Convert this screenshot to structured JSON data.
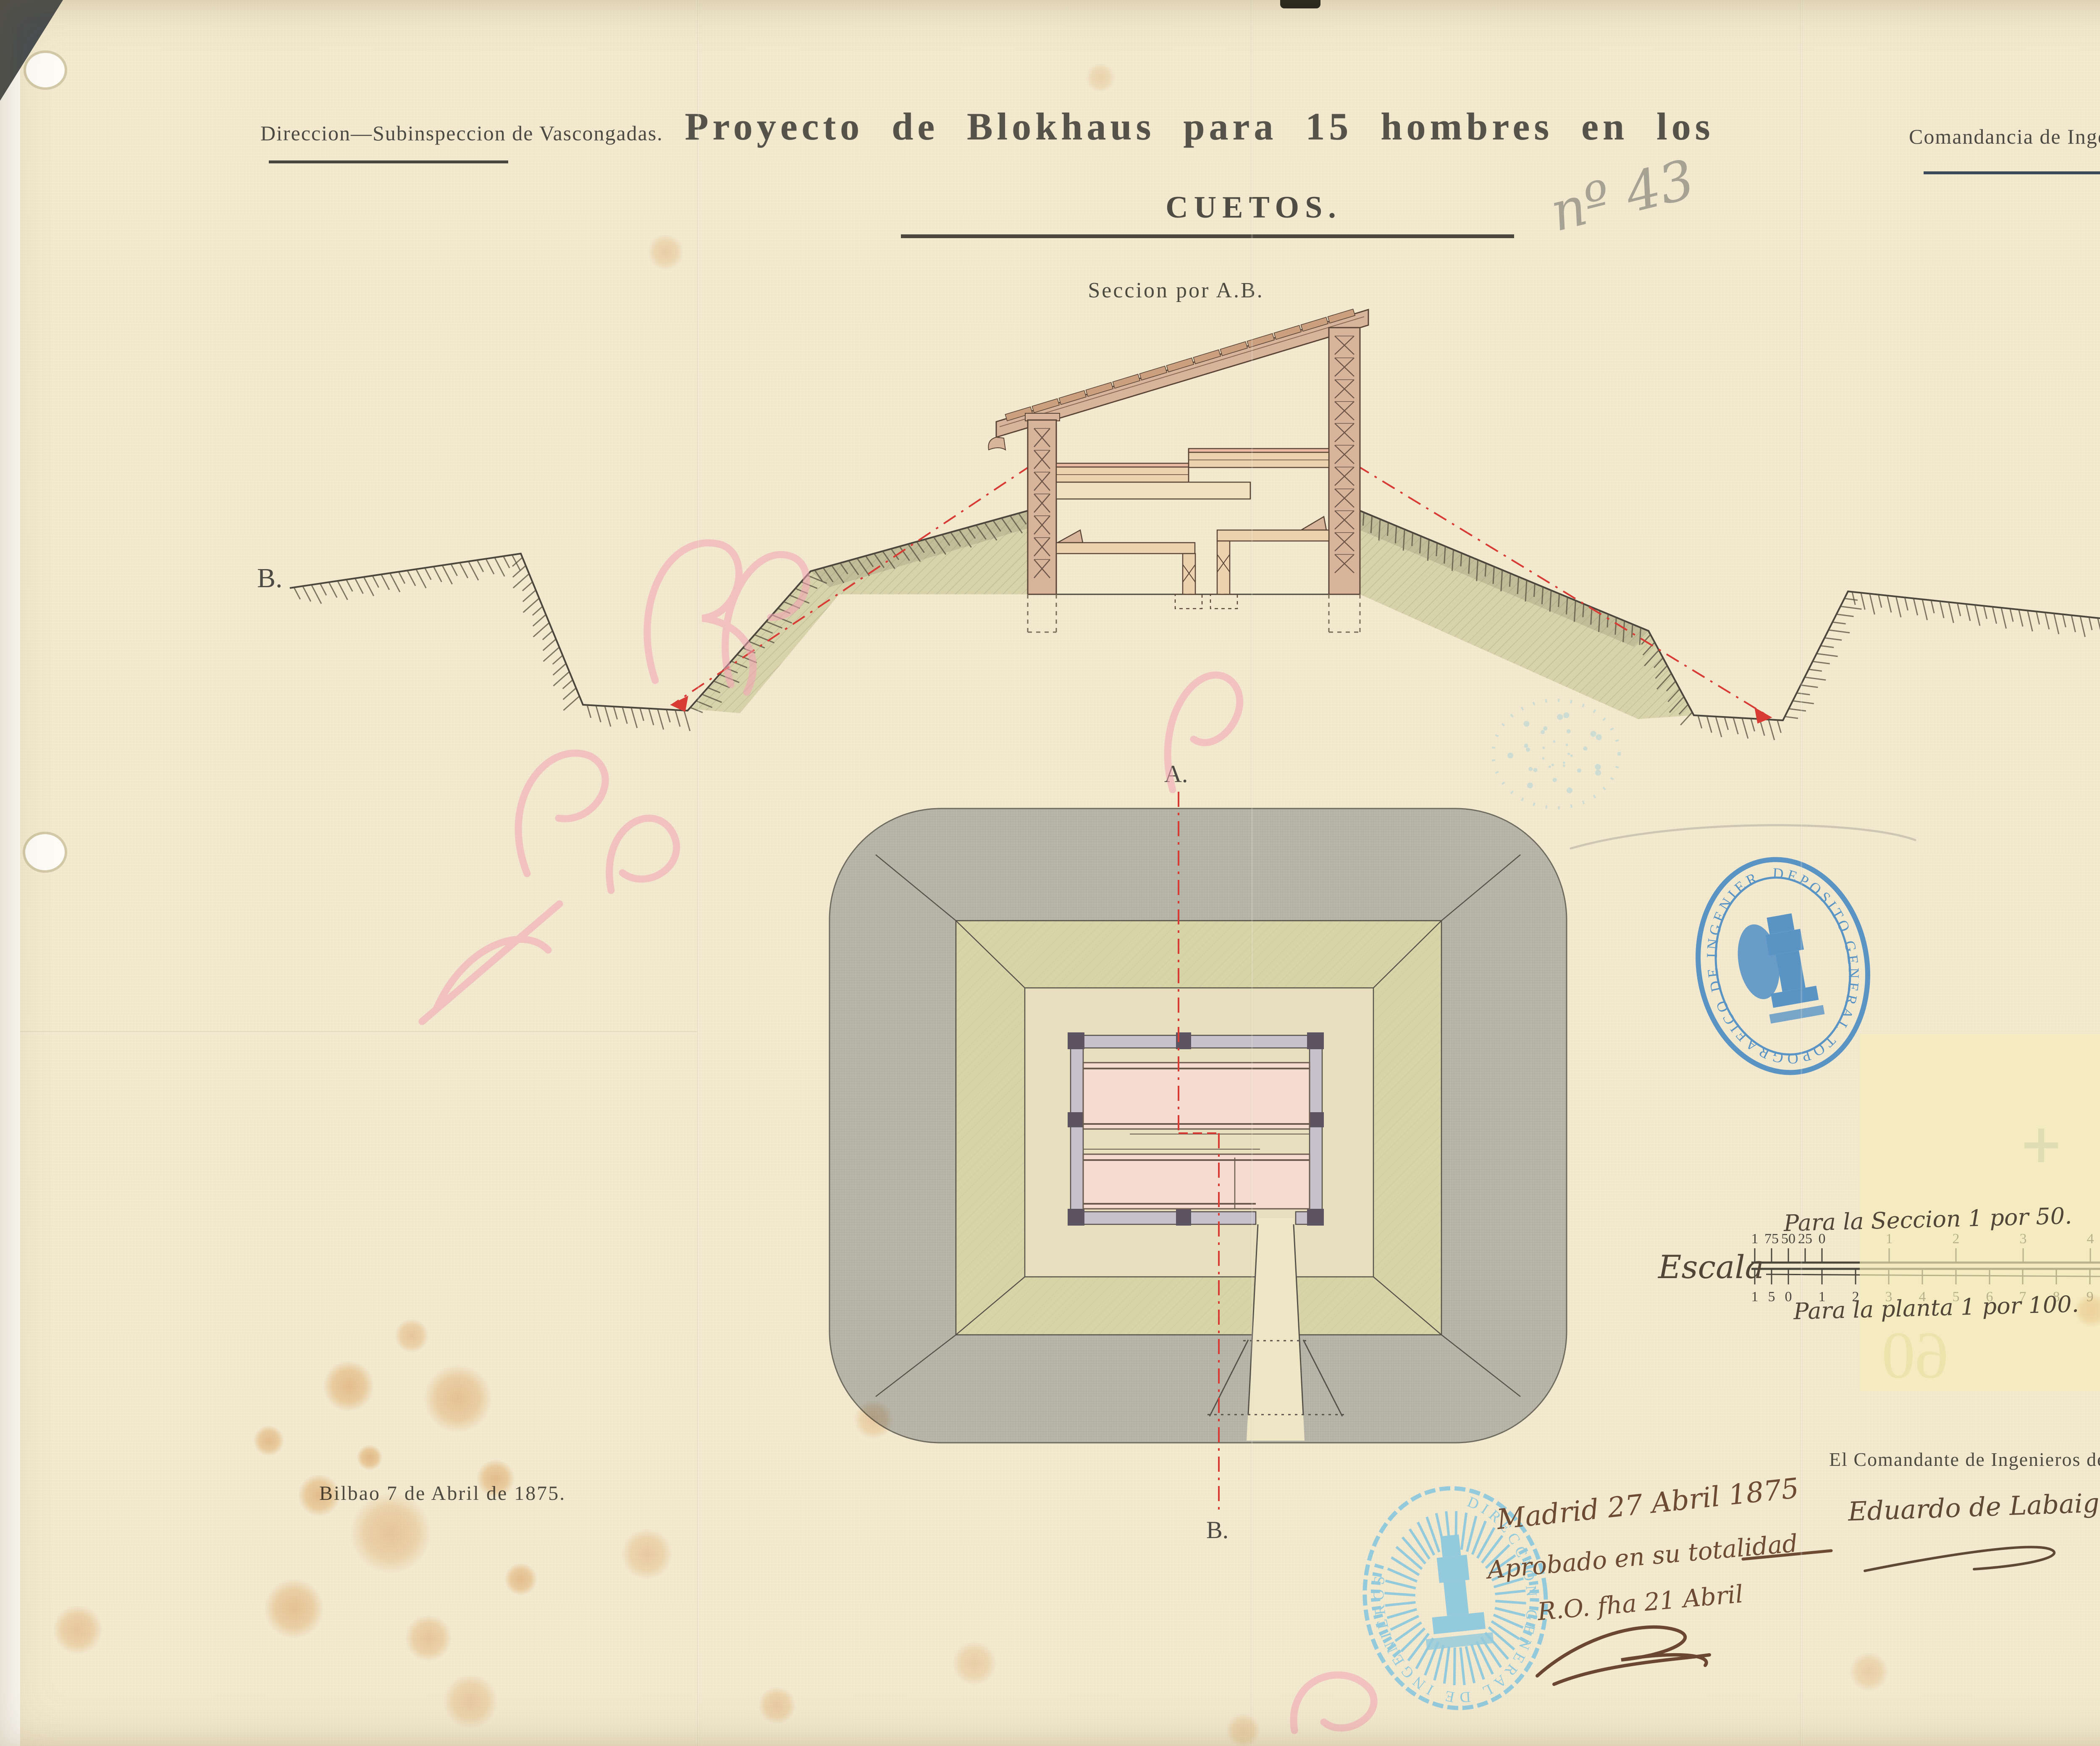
{
  "document": {
    "header_left": "Direccion—Subinspeccion de Vascongadas.",
    "header_right": "Comandancia de Ingenieros de Bilbao.",
    "title_line1": "Proyecto de Blokhaus para 15 hombres en los",
    "title_line2": "CUETOS.",
    "pencil_number": "nº 43",
    "section_caption": "Seccion por A.B.",
    "section_label_left": "B.",
    "section_label_right": "A.",
    "plan_label_top": "A.",
    "plan_label_bottom": "B.",
    "date_place": "Bilbao 7 de Abril de 1875.",
    "approval_line1": "Madrid 27 Abril 1875",
    "approval_line2": "Aprobado en su totalidad",
    "approval_line3": "R.O. fha 21 Abril",
    "signature_title": "El Comandante de Ingenieros de la plaza.",
    "signature_name": "Eduardo de Labaig"
  },
  "scale_bar": {
    "label": "Escala",
    "caption_top": "Para la Seccion 1 por 50.",
    "caption_bottom": "Para la planta 1 por 100.",
    "unit": "metros.",
    "top_ticks": [
      "1",
      "75",
      "50",
      "25",
      "0",
      "1",
      "2",
      "3",
      "4",
      "5"
    ],
    "bottom_ticks": [
      "1",
      "5",
      "0",
      "1",
      "2",
      "3",
      "4",
      "5",
      "6",
      "7",
      "8",
      "9",
      "10",
      "11"
    ]
  },
  "stamps": {
    "middle_oval_text": "DEPOSITO GENERAL TOPOGRAFICO DE INGENIEROS",
    "bottom_oval_text": "DIRECCION GENERAL DE INGENIEROS"
  },
  "show_through": {
    "verso_card_fields": [
      "Número",
      "Signatura",
      "N.º de hojas",
      "Hoja n.º"
    ],
    "ghost_number": "60"
  },
  "colors": {
    "paper": "#f3ead0",
    "paperdark": "#e9dfbf",
    "earthgray": "#b8b6a9",
    "olive": "#d9d4a8",
    "mound": "#d8d2ab",
    "wood": "#d8b49a",
    "woodlight": "#ecd2ae",
    "pinkroom": "#f6dcd0",
    "red": "#d83a34",
    "pinkscript": "#f2a3b4",
    "stampblue": "#3f86c4",
    "stamplightblue": "#7cc3e0",
    "inkline": "#4a463c"
  }
}
